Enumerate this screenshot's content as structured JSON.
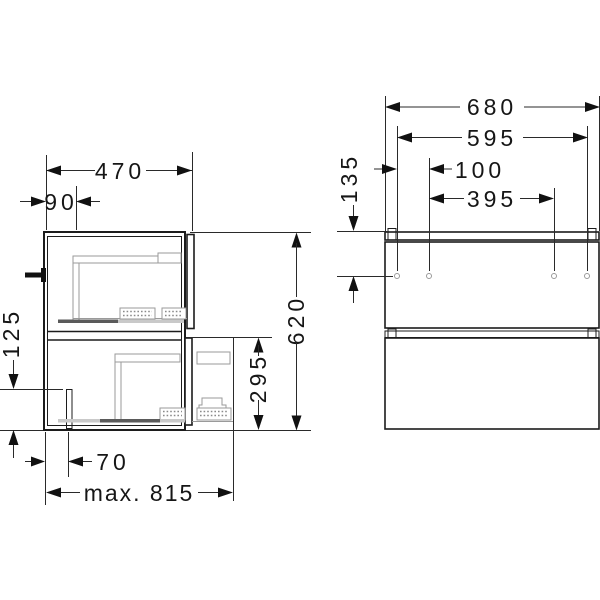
{
  "drawing": {
    "background": "#ffffff",
    "line_color": "#1c1c1c",
    "hardware_color": "#9a9a9a",
    "side": {
      "depth": "470",
      "back_offset": "90",
      "cutout_height": "125",
      "cutout_offset": "70",
      "max_depth": "max. 815",
      "total_height": "620",
      "drawer_front_height": "295"
    },
    "front": {
      "width": "680",
      "hole_span_outer": "595",
      "hole_pitch": "100",
      "hole_span_inner": "395",
      "top_to_holes": "135"
    }
  }
}
